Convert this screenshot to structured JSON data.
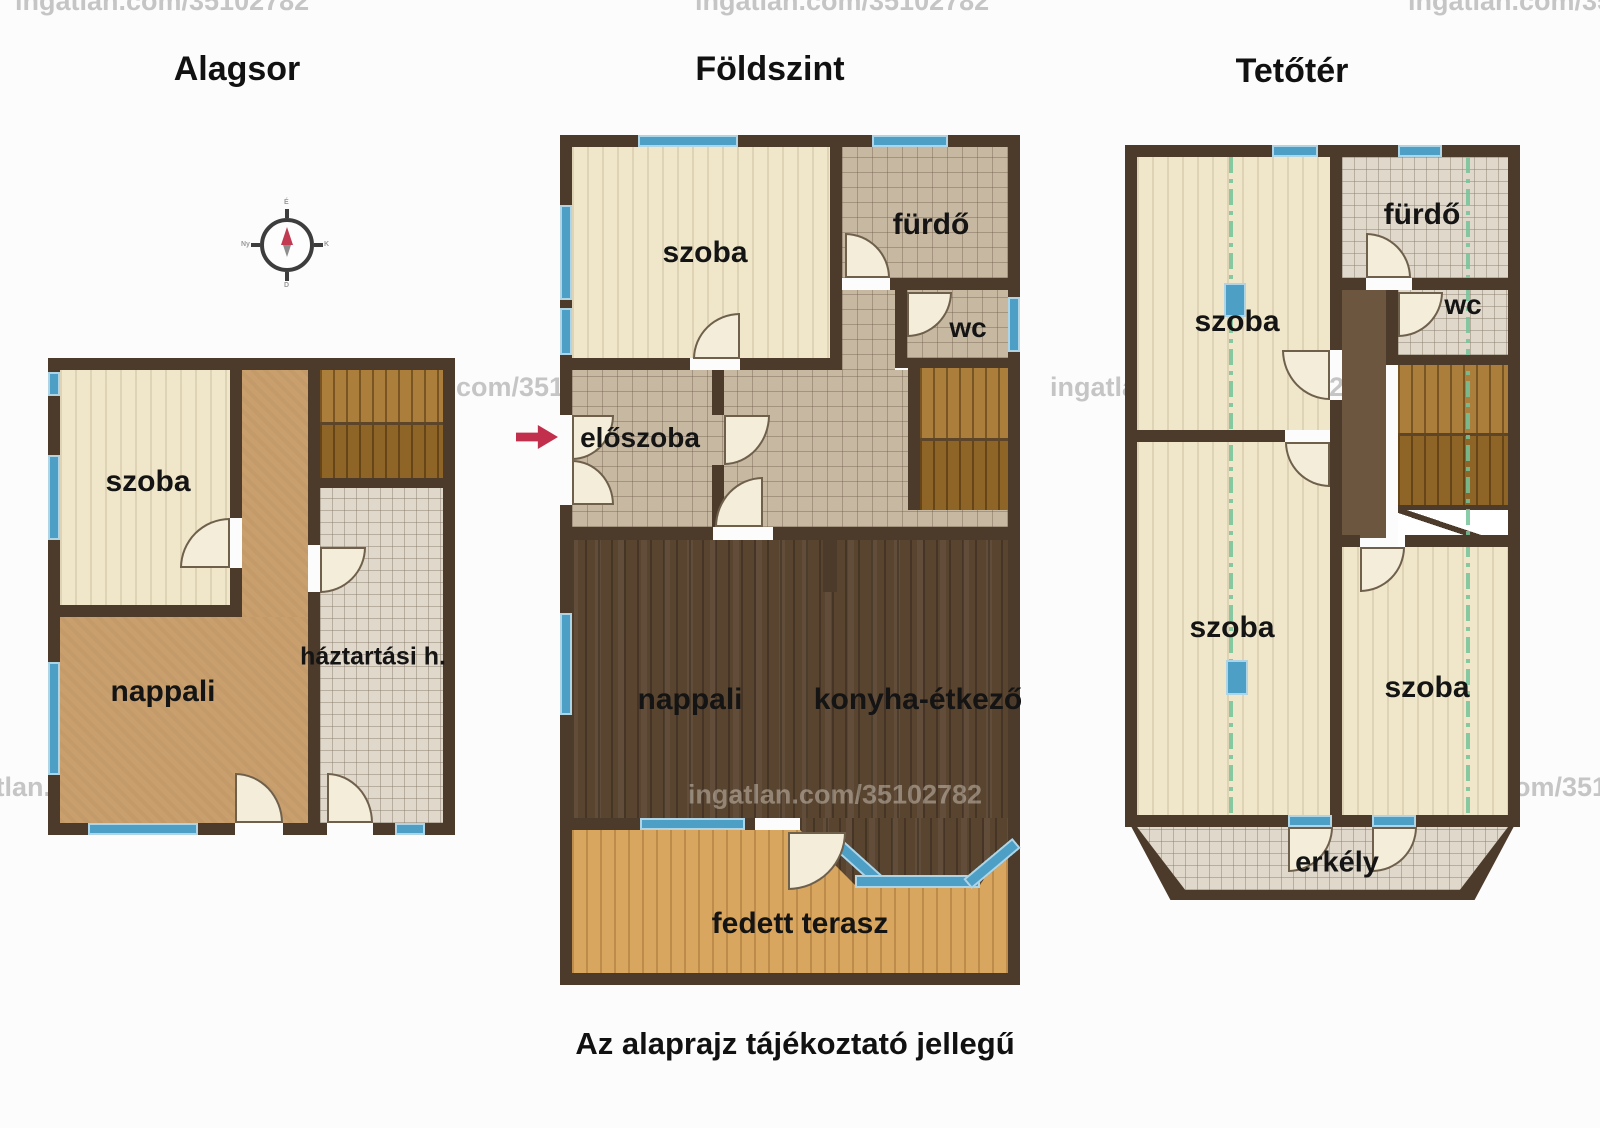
{
  "page": {
    "disclaimer": "Az alaprajz tájékoztató jellegű",
    "watermark": "ingatlan.com/35102782"
  },
  "colors": {
    "wall": "#4c3b2b",
    "window_blue": "#4d9fc6",
    "door_fill": "#f3edda",
    "entrance_arrow_red": "#c22f4c",
    "attic_height_line_green": "#74c398",
    "dark_wood_floor": "#594430",
    "terrace_wood_floor": "#d8a65f",
    "cream_wood_floor": "#f0e7ca",
    "tan_floor": "#c99f6d"
  },
  "compass": {
    "north": "É",
    "east": "K",
    "south": "D",
    "west": "Ny"
  },
  "plans": {
    "alagsor": {
      "title": "Alagsor",
      "rooms": {
        "szoba": "szoba",
        "nappali": "nappali",
        "haztartasi": "háztartási h."
      }
    },
    "foldszint": {
      "title": "Földszint",
      "rooms": {
        "szoba": "szoba",
        "furdo": "fürdő",
        "wc": "wc",
        "eloszoba": "előszoba",
        "nappali": "nappali",
        "konyha": "konyha-étkező",
        "terasz": "fedett terasz"
      }
    },
    "tetoter": {
      "title": "Tetőtér",
      "rooms": {
        "szoba_felso": "szoba",
        "furdo": "fürdő",
        "wc": "wc",
        "szoba_also_bal": "szoba",
        "szoba_also_jobb": "szoba",
        "erkely": "erkély"
      }
    }
  }
}
